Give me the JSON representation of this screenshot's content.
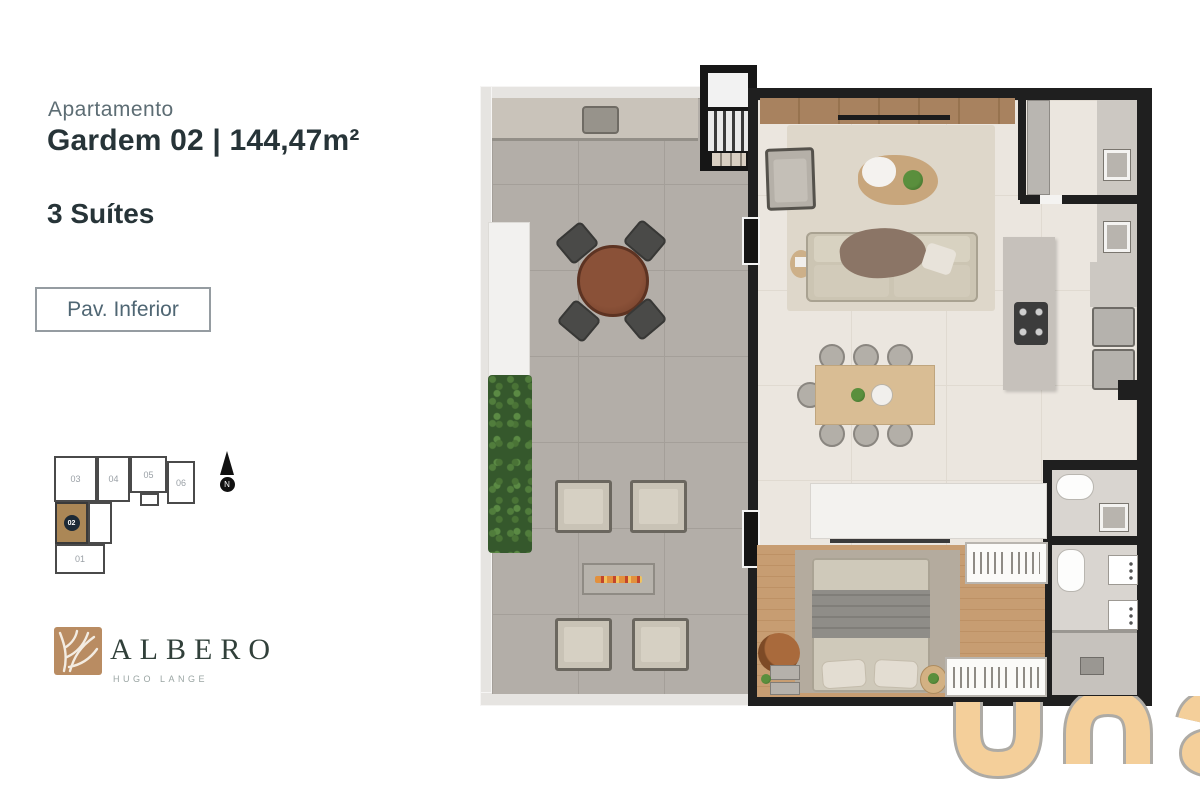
{
  "header": {
    "label": "Apartamento",
    "title": "Gardem 02 | 144,47m²",
    "suites": "3 Suítes",
    "floor_button_label": "Pav. Inferior"
  },
  "keyplan": {
    "north_label": "N",
    "highlighted_unit": "02",
    "units": [
      {
        "label": "03"
      },
      {
        "label": "04"
      },
      {
        "label": "05"
      },
      {
        "label": "06"
      },
      {
        "label": "02"
      },
      {
        "label": "01"
      }
    ]
  },
  "branding": {
    "logo_name": "ALBERO",
    "logo_subtitle": "HUGO LANGE",
    "watermark_text": "una"
  },
  "floor_plan": {
    "rooms": [
      "terrace",
      "living-room",
      "dining-area",
      "kitchen",
      "lavabo",
      "bathroom",
      "suite-bedroom",
      "suite-bathroom",
      "staircase"
    ],
    "colors": {
      "wall": "#1f1f1f",
      "terrace_floor": "#b3aea8",
      "interior_floor": "#ebe6df",
      "wood_floor": "#c79d72",
      "unit_highlight": "#ab8756",
      "watermark_tan": "#f4cf9a",
      "logo_green": "#31403a",
      "logo_brown": "#b98c62",
      "title_text": "#273438",
      "muted_text": "#5d6d74"
    }
  }
}
